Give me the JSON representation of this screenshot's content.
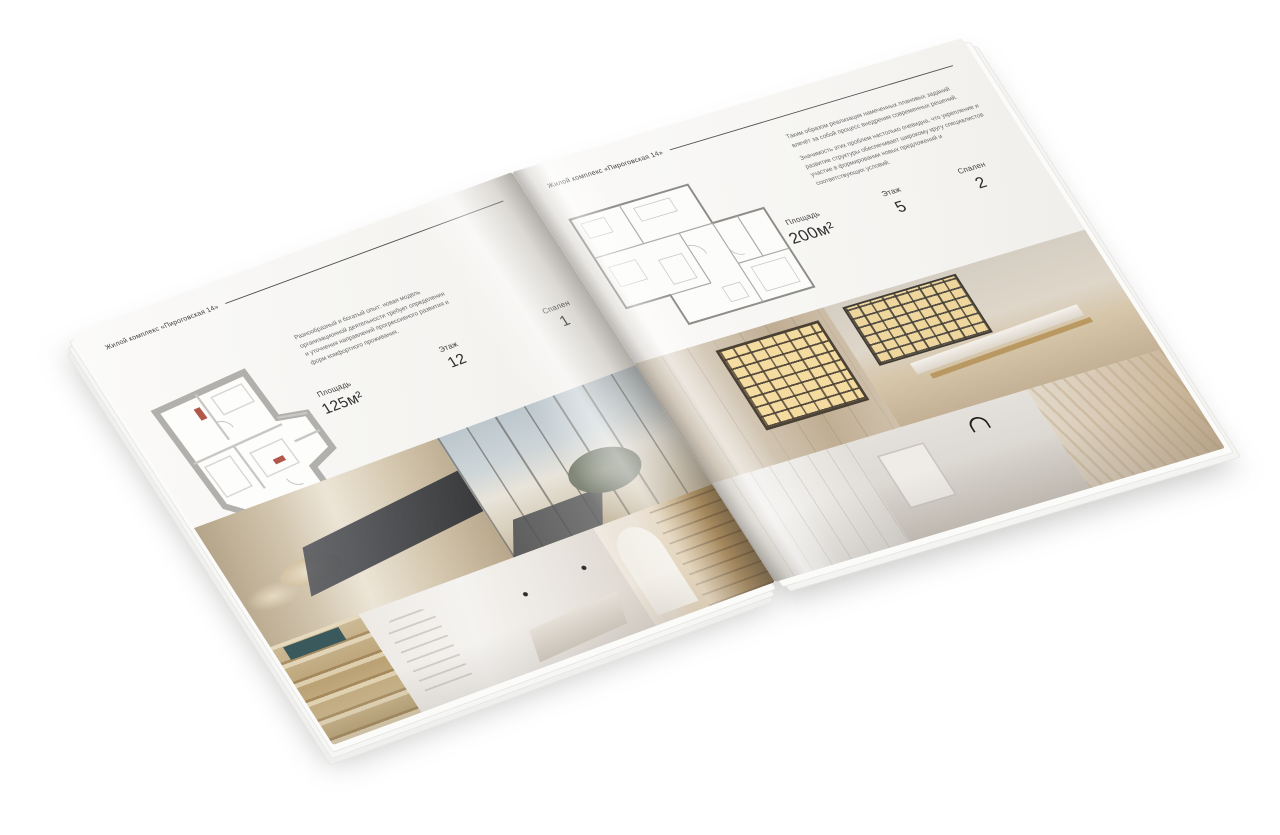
{
  "brand": {
    "title": "Жилой комплекс «Пироговская 14»"
  },
  "left_page": {
    "header": "Жилой комплекс «Пироговская 14»",
    "description": "Разнообразный и богатый опыт: новая модель организационной деятельности требует определения и уточнения направлений прогрессивного развития и форм комфортного проживания.",
    "specs": [
      {
        "label": "Площадь",
        "value": "125м²"
      },
      {
        "label": "Этаж",
        "value": "12"
      },
      {
        "label": "Спален",
        "value": "1"
      }
    ]
  },
  "right_page": {
    "header": "Жилой комплекс «Пироговская 14»",
    "paragraph1": "Таким образом реализация намеченных плановых заданий влечёт за собой процесс внедрения современных решений.",
    "paragraph2": "Значимость этих проблем настолько очевидна, что укрепление и развитие структуры обеспечивает широкому кругу специалистов участие в формировании новых предложений и соответствующих условий.",
    "specs": [
      {
        "label": "Площадь",
        "value": "200м²"
      },
      {
        "label": "Этаж",
        "value": "5"
      },
      {
        "label": "Спален",
        "value": "2"
      }
    ]
  }
}
